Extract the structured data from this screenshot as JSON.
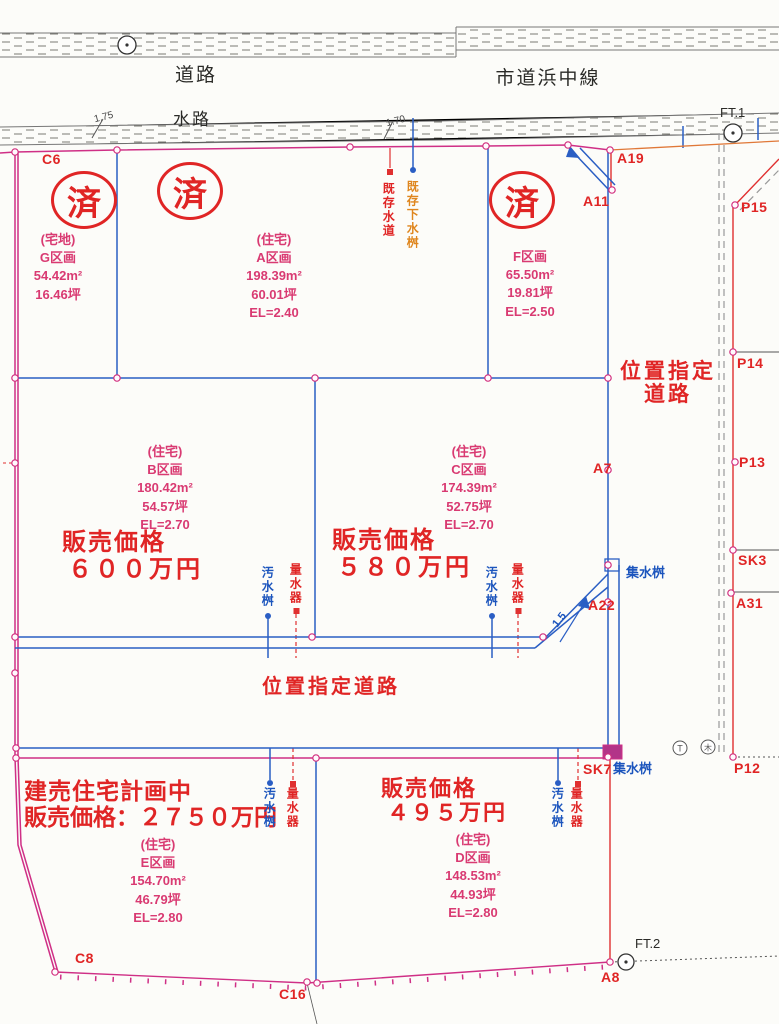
{
  "plan": {
    "roads": {
      "top": "道路",
      "city_line": "市道浜中線",
      "waterway": "水路",
      "designated_v1": "位置指定",
      "designated_v2": "道路",
      "designated_h": "位置指定道路"
    },
    "benchmarks": {
      "ft1": "FT.1",
      "ft2": "FT.2"
    },
    "measurements": {
      "m1": "1.75",
      "m2": "1.70",
      "m3": "1.5"
    },
    "stamp": "済",
    "points": {
      "c6": "C6",
      "a19": "A19",
      "a11": "A11",
      "p15": "P15",
      "p14": "P14",
      "p13": "P13",
      "sk3": "SK3",
      "a31": "A31",
      "a7": "A7",
      "a22": "A22",
      "sk7": "SK7",
      "p12": "P12",
      "a8": "A8",
      "c16": "C16",
      "c8": "C8"
    },
    "utilities": {
      "sewer_basin": "汚水桝",
      "water_meter": "量水器",
      "catch_basin": "集水桝",
      "existing_water": "既存水道",
      "existing_sewer": "既存下水桝"
    },
    "symbols": {
      "pole1": "T",
      "pole2": "木"
    },
    "parcels": {
      "g": {
        "use": "(宅地)",
        "name": "G区画",
        "area": "54.42m²",
        "tsubo": "16.46坪"
      },
      "a": {
        "use": "(住宅)",
        "name": "A区画",
        "area": "198.39m²",
        "tsubo": "60.01坪",
        "el": "EL=2.40"
      },
      "f": {
        "name": "F区画",
        "area": "65.50m²",
        "tsubo": "19.81坪",
        "el": "EL=2.50"
      },
      "b": {
        "use": "(住宅)",
        "name": "B区画",
        "area": "180.42m²",
        "tsubo": "54.57坪",
        "el": "EL=2.70",
        "price_label": "販売価格",
        "price": "６００万円"
      },
      "c": {
        "use": "(住宅)",
        "name": "C区画",
        "area": "174.39m²",
        "tsubo": "52.75坪",
        "el": "EL=2.70",
        "price_label": "販売価格",
        "price": "５８０万円"
      },
      "d": {
        "use": "(住宅)",
        "name": "D区画",
        "area": "148.53m²",
        "tsubo": "44.93坪",
        "el": "EL=2.80",
        "price_label": "販売価格",
        "price": "４９５万円"
      },
      "e": {
        "use": "(住宅)",
        "name": "E区画",
        "area": "154.70m²",
        "tsubo": "46.79坪",
        "el": "EL=2.80",
        "plan_note": "建売住宅計画中",
        "price_line": "販売価格：２７５０万円"
      }
    },
    "colors": {
      "boundary": "#cf2f86",
      "accent_red": "#e02525",
      "line_blue": "#2a5ec4",
      "orange": "#e5821e"
    }
  }
}
